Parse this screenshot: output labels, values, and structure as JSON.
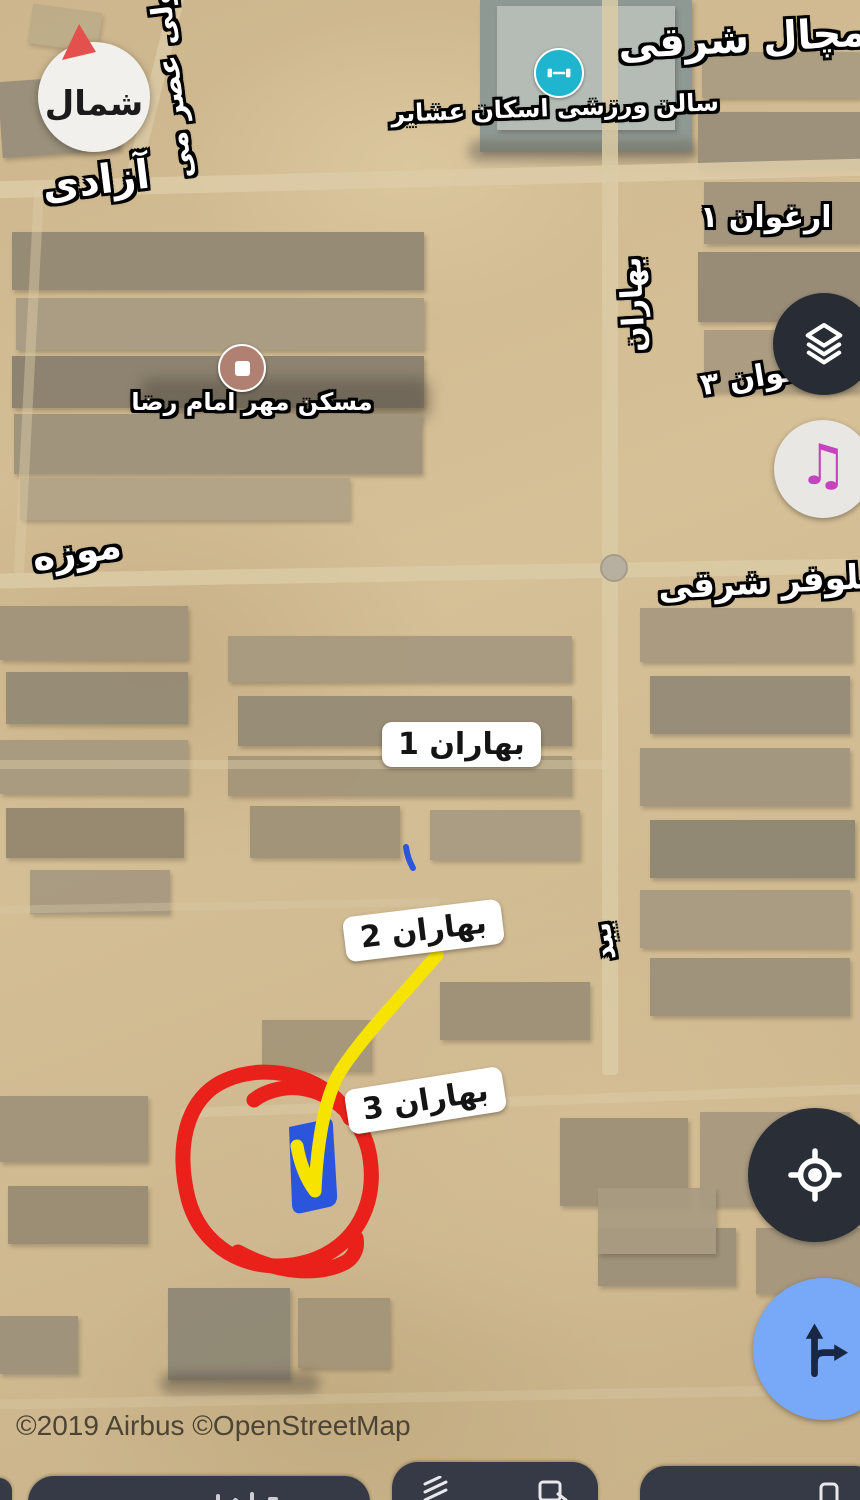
{
  "attribution": "©2019 Airbus ©OpenStreetMap",
  "compass": {
    "label": "شمال"
  },
  "labels": {
    "azadi": "آزادی",
    "vali_asr": "ولی عصر می",
    "mechal_sharghi": "مچال شرقی",
    "arghavan_1": "ارغوان ۱",
    "arghavan_3": "ارغوان ۳",
    "muzeh": "موزه",
    "niloofar_sharghi": "نیلوفر شرقی",
    "baharan_street": "بهاران",
    "bid_street": "بید",
    "baharan_1": "بهاران 1",
    "baharan_2": "بهاران 2",
    "baharan_3": "بهاران 3"
  },
  "pois": [
    {
      "name": "سالن ورزشی اسکان عشایر",
      "icon": "dumbbell-icon",
      "color": "#1fb5ce"
    },
    {
      "name": "مسکن مهر امام رضا",
      "icon": "square-icon",
      "color": "#b08173"
    }
  ],
  "controls": {
    "layers": "layers-icon",
    "music": "music-note-icon",
    "my_location": "gps-crosshair-icon",
    "directions": "directions-icon"
  },
  "annotations": {
    "circle_color": "#ea211b",
    "arrow_color": "#f6e400",
    "plot_color": "#2b55dd"
  }
}
